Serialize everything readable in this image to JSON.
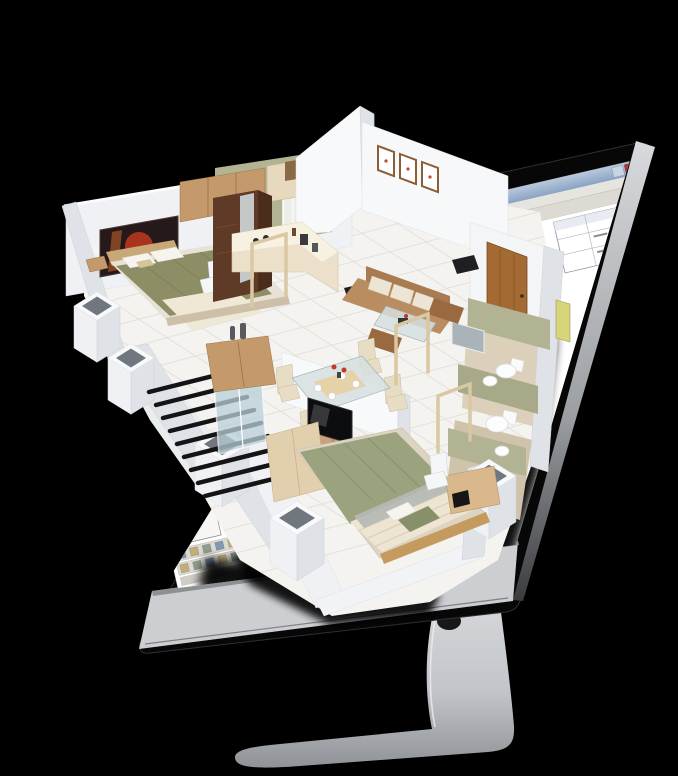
{
  "scene": {
    "type": "3d-marketing-render",
    "description": "Isometric 3D apartment floor plan bursting out of a desktop monitor that displays CAD floor-planning software",
    "watermark": "cad",
    "close_glyph": "x"
  },
  "monitor": {
    "style": "aluminum all-in-one with black glass bezel, silver chin and curved foot stand",
    "cable_hole": true
  },
  "screen_ui": {
    "window": "cad-application",
    "titlebar_buttons": [
      "minimize",
      "close"
    ],
    "left_panel_folder_rows": 6,
    "top_toolbar_icon_count": 12,
    "bottom_toolbar_icon_counts": [
      10,
      12
    ],
    "properties_table": {
      "rows": 3,
      "columns": 3
    }
  },
  "floor_plan": {
    "structure": [
      "white-cutaway-walls",
      "hollow-columns",
      "white-tiled-floor",
      "open-pine-door-frames"
    ],
    "rooms": [
      {
        "name": "bedroom-1",
        "items": [
          "double-bed",
          "olive-duvet",
          "white-pillows",
          "cream-throw",
          "headboard",
          "nightstand",
          "table-lamp",
          "red-wall-art",
          "dark-wardrobe",
          "white-chair"
        ]
      },
      {
        "name": "kitchen",
        "items": [
          "upper-cabinets",
          "olive-backsplash",
          "curtained-window",
          "l-shaped-counter",
          "hob",
          "small-appliances"
        ]
      },
      {
        "name": "living-room",
        "items": [
          "three-picture-frames",
          "tan-sofa",
          "cushions",
          "side-tables",
          "table-lamps",
          "glass-coffee-table",
          "two-ottomans",
          "brown-entry-door"
        ]
      },
      {
        "name": "dining-area",
        "items": [
          "glass-dining-table",
          "four-cream-chairs",
          "plates",
          "red-flowers",
          "sideboard",
          "decor-vases"
        ]
      },
      {
        "name": "balcony",
        "items": [
          "black-slat-railing",
          "sliding-glass-door"
        ]
      },
      {
        "name": "bedroom-2",
        "items": [
          "double-bed",
          "sage-duvet",
          "striped-cream-sheet",
          "sage-pillows",
          "gray-blanket",
          "tv",
          "tv-cabinet",
          "wardrobe",
          "dresser",
          "white-chair"
        ]
      },
      {
        "name": "bathroom-1",
        "items": [
          "toilet",
          "washbasin",
          "mirror",
          "shower-panel"
        ]
      },
      {
        "name": "bathroom-2",
        "items": [
          "toilet",
          "washbasin"
        ]
      }
    ]
  },
  "colors": {
    "bg": "#000000",
    "bezel": "#070708",
    "bezelEdge": "#2e3033",
    "chin": "#ccced1",
    "chinLine": "#8e9194",
    "hole": "#17181a",
    "winbg": "#e8e6e0",
    "close": "#b03a2e",
    "menubg": "#e6e4de",
    "toolbg": "#dcdad2",
    "icoA": "#7f98b4",
    "icoB": "#c2ae77",
    "icoC": "#8fa08d",
    "canvas": "#ffffff",
    "folder": "#e7c64a",
    "wallTop": "#f8f9fb",
    "wallFace": "#eff1f4",
    "wallShade": "#dfe3e8",
    "floor": "#f4f3f0",
    "tile": "#e3e1dc",
    "olive": "#b2b392",
    "wood": "#c49a6c",
    "darkwood": "#5f3b27",
    "pine": "#d9c8a2",
    "door": "#a46a33",
    "glass": "#b9cfd8",
    "sofa": "#b98d5f",
    "ottoman": "#9a693f",
    "tableGlass": "#d7e0e0",
    "chair": "#e7dcc4",
    "bedOlive": "#8d8d66",
    "pillow": "#f6f4ee",
    "throw": "#efe8d4",
    "headboard": "#c9a877",
    "sage": "#9aa37d",
    "creamSheet": "#ede5d1",
    "mirror": "#aab3b8",
    "artDark": "#26191a",
    "artRed": "#c03a1f"
  }
}
